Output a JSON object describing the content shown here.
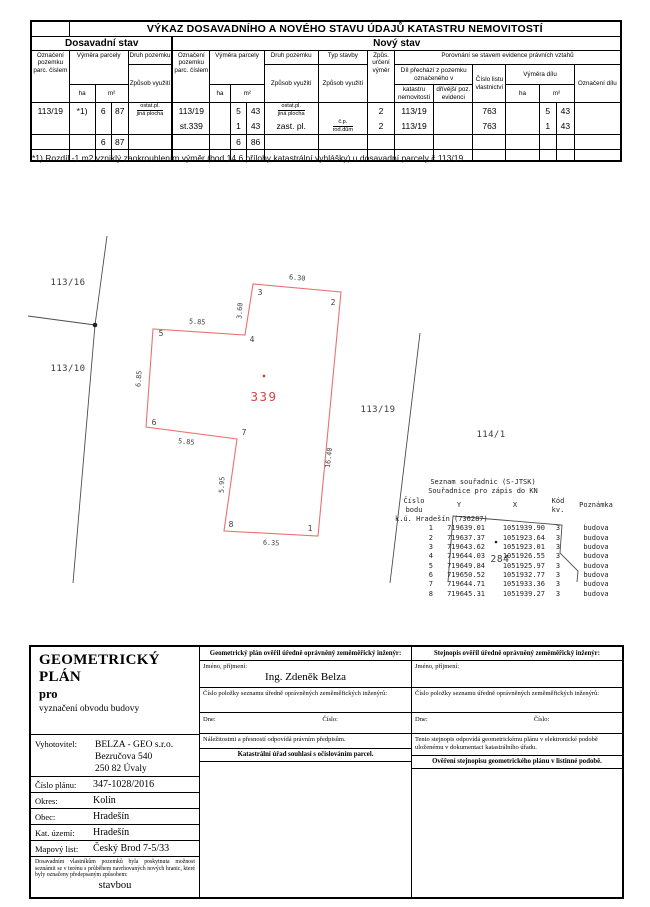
{
  "vykaz": {
    "title": "VÝKAZ DOSAVADNÍHO A NOVÉHO STAVU ÚDAJŮ KATASTRU NEMOVITOSTÍ",
    "section_old": "Dosavadní stav",
    "section_new": "Nový stav",
    "headers": {
      "ozn_pozemku": "Označení pozemku parc. číslem",
      "vymera_parcely": "Výměra parcely",
      "druh_pozemku": "Druh pozemku",
      "zpusob_vyuziti": "Způsob využití",
      "typ_stavby": "Typ stavby",
      "zpus_urceni": "Způs. určení výměr",
      "porovnani": "Porovnání se stavem evidence právních vztahů",
      "dil_prechazi": "Díl přechází z pozemku označeného v",
      "katastru": "katastru nemovitostí",
      "drivejsi": "dřívější poz. evidenci",
      "cislo_lv": "Číslo listu vlastnictví",
      "vymera_dilu": "Výměra dílu",
      "oznaceni_dilu": "Označení dílu",
      "ha": "ha",
      "m2": "m²"
    },
    "row1": {
      "old_parc": "113/19",
      "old_note": "*1)",
      "old_m2a": "6",
      "old_m2b": "87",
      "old_druh_top": "ostat.pl.",
      "old_druh_bot": "jiná plocha",
      "new_parc": "113/19",
      "new_m2a": "5",
      "new_m2b": "43",
      "new_druh_top": "ostat.pl.",
      "new_druh_bot": "jiná plocha",
      "zpus": "2",
      "kat": "113/19",
      "lv": "763",
      "dil_m2a": "5",
      "dil_m2b": "43"
    },
    "row2": {
      "new_parc": "st.339",
      "new_m2a": "1",
      "new_m2b": "43",
      "new_druh": "zast. pl.",
      "typ_top": "č.p.",
      "typ_bot": "rod.dům",
      "zpus": "2",
      "kat": "113/19",
      "lv": "763",
      "dil_m2a": "1",
      "dil_m2b": "43"
    },
    "totals": {
      "old_m2a": "6",
      "old_m2b": "87",
      "new_m2a": "6",
      "new_m2b": "86"
    }
  },
  "note": "*1) Rozdíl -1 m2 vzniklý zaokrouhlením výměr (bod 14.6 přílohy katastrální vyhlášky) u dosavadní parcely č.113/19",
  "drawing": {
    "boundary_lines": [
      {
        "name": "west-boundary",
        "points": [
          [
            107,
            8
          ],
          [
            95,
            97
          ],
          [
            73,
            355
          ]
        ]
      },
      {
        "name": "west-boundary-branch",
        "points": [
          [
            28,
            88
          ],
          [
            95,
            97
          ]
        ]
      },
      {
        "name": "east-boundary",
        "points": [
          [
            420,
            105
          ],
          [
            390,
            355
          ]
        ]
      }
    ],
    "building": {
      "number": "339",
      "points": [
        [
          318,
          308
        ],
        [
          341,
          64
        ],
        [
          253,
          56
        ],
        [
          245,
          107
        ],
        [
          153,
          101
        ],
        [
          146,
          199
        ],
        [
          237,
          211
        ],
        [
          224,
          303
        ]
      ]
    },
    "building_284": {
      "points": [
        [
          448,
          354
        ],
        [
          453,
          288
        ],
        [
          562,
          297
        ],
        [
          560,
          325
        ],
        [
          578,
          343
        ],
        [
          577,
          354
        ]
      ]
    },
    "dots": [
      {
        "name": "boundary-junction-dot",
        "cls": "black",
        "x": 95,
        "y": 97,
        "r": 2.3
      },
      {
        "name": "building-339-point",
        "cls": "red",
        "x": 264,
        "y": 148,
        "r": 1.4
      },
      {
        "name": "building-284-point",
        "cls": "black",
        "x": 496,
        "y": 314,
        "r": 1.3
      }
    ],
    "svg_labels": [
      {
        "t": "1",
        "x": 310,
        "y": 303,
        "cls": "vertex",
        "name": "vertex-label-1"
      },
      {
        "t": "2",
        "x": 333,
        "y": 77,
        "cls": "vertex",
        "name": "vertex-label-2"
      },
      {
        "t": "3",
        "x": 260,
        "y": 67,
        "cls": "vertex",
        "name": "vertex-label-3"
      },
      {
        "t": "4",
        "x": 252,
        "y": 114,
        "cls": "vertex",
        "name": "vertex-label-4"
      },
      {
        "t": "5",
        "x": 161,
        "y": 108,
        "cls": "vertex",
        "name": "vertex-label-5"
      },
      {
        "t": "6",
        "x": 154,
        "y": 197,
        "cls": "vertex",
        "name": "vertex-label-6"
      },
      {
        "t": "7",
        "x": 244,
        "y": 207,
        "cls": "vertex",
        "name": "vertex-label-7"
      },
      {
        "t": "8",
        "x": 231,
        "y": 299,
        "cls": "vertex",
        "name": "vertex-label-8"
      },
      {
        "t": "6.30",
        "x": 297,
        "y": 52,
        "r": 5,
        "cls": "dim",
        "name": "dim-label-6-30"
      },
      {
        "t": "3.60",
        "x": 242,
        "y": 83,
        "r": -86,
        "cls": "dim",
        "name": "dim-label-3-60"
      },
      {
        "t": "5.85",
        "x": 197,
        "y": 96,
        "r": 4,
        "cls": "dim",
        "name": "dim-label-5-85-a"
      },
      {
        "t": "6.85",
        "x": 141,
        "y": 151,
        "r": -86,
        "cls": "dim",
        "name": "dim-label-6-85"
      },
      {
        "t": "5.85",
        "x": 186,
        "y": 216,
        "r": 6,
        "cls": "dim",
        "name": "dim-label-5-85-b"
      },
      {
        "t": "5.95",
        "x": 224,
        "y": 257,
        "r": -87,
        "cls": "dim",
        "name": "dim-label-5-95"
      },
      {
        "t": "6.35",
        "x": 271,
        "y": 317,
        "r": 3,
        "cls": "dim",
        "name": "dim-label-6-35"
      },
      {
        "t": "16.40",
        "x": 331,
        "y": 230,
        "r": -84,
        "cls": "dim",
        "name": "dim-label-16-40"
      },
      {
        "t": "113/16",
        "x": 68,
        "y": 57,
        "cls": "parcel",
        "name": "parcel-label-113-16"
      },
      {
        "t": "113/10",
        "x": 68,
        "y": 143,
        "cls": "parcel",
        "name": "parcel-label-113-10"
      },
      {
        "t": "113/19",
        "x": 378,
        "y": 184,
        "cls": "parcel",
        "name": "parcel-label-113-19"
      },
      {
        "t": "114/1",
        "x": 491,
        "y": 209,
        "cls": "parcel",
        "name": "parcel-label-114-1"
      },
      {
        "t": "284",
        "x": 500,
        "y": 334,
        "cls": "p284",
        "name": "parcel-label-284"
      },
      {
        "t": "339",
        "x": 264,
        "y": 173,
        "cls": "bldnum",
        "name": "building-339-number"
      }
    ],
    "coord_list": {
      "title1": "Seznam souřadnic (S-JTSK)",
      "title2": "Souřadnice pro zápis do KN",
      "cols": [
        "Číslo bodu",
        "Y",
        "X",
        "Kód kv.",
        "Poznámka"
      ],
      "subheader": "k.ú. Hradešín (736287)",
      "rows": [
        [
          "1",
          "719639.01",
          "1051939.90",
          "3",
          "budova"
        ],
        [
          "2",
          "719637.37",
          "1051923.64",
          "3",
          "budova"
        ],
        [
          "3",
          "719643.62",
          "1051923.01",
          "3",
          "budova"
        ],
        [
          "4",
          "719644.03",
          "1051926.55",
          "3",
          "budova"
        ],
        [
          "5",
          "719649.84",
          "1051925.97",
          "3",
          "budova"
        ],
        [
          "6",
          "719650.52",
          "1051932.77",
          "3",
          "budova"
        ],
        [
          "7",
          "719644.71",
          "1051933.36",
          "3",
          "budova"
        ],
        [
          "8",
          "719645.31",
          "1051939.27",
          "3",
          "budova"
        ]
      ]
    }
  },
  "footer": {
    "left": {
      "title": "GEOMETRICKÝ PLÁN",
      "subtitle": "pro",
      "purpose": "vyznačení obvodu budovy",
      "vyhotovitel_label": "Vyhotovitel:",
      "vyhotovitel_lines": [
        "BELZA - GEO s.r.o.",
        "Bezručova 540",
        "250 82 Úvaly"
      ],
      "rows": [
        {
          "label": "Číslo plánu:",
          "value": "347-1028/2016"
        },
        {
          "label": "Okres:",
          "value": "Kolín"
        },
        {
          "label": "Obec:",
          "value": "Hradešín"
        },
        {
          "label": "Kat. území:",
          "value": "Hradešín"
        },
        {
          "label": "Mapový list:",
          "value": "Český Brod 7-5/33"
        }
      ],
      "smallprint": "Dosavadním vlastníkům pozemků byla poskytnuta možnost seznámit se v terénu s průběhem navrhovaných nových hranic, které byly označeny předepsaným způsobem:",
      "smallprint_value": "stavbou"
    },
    "middle": {
      "header": "Geometrický plán ověřil úředně oprávněný zeměměřický inženýr:",
      "name_label": "Jméno, příjmení:",
      "name_value": "Ing. Zdeněk Belza",
      "cislo_polozky": "Číslo položky seznamu úředně oprávněných zeměměřických inženýrů:",
      "dne_label": "Dne:",
      "cislo_label": "Číslo:",
      "footnote": "Náležitostmi a přesností odpovídá právním předpisům.",
      "section2": "Katastrální úřad souhlasí s očíslováním parcel."
    },
    "right": {
      "header": "Stejnopis ověřil úředně oprávněný zeměměřický inženýr:",
      "name_label": "Jméno, příjmení:",
      "name_value": "",
      "cislo_polozky": "Číslo položky seznamu úředně oprávněných zeměměřických inženýrů:",
      "dne_label": "Dne:",
      "cislo_label": "Číslo:",
      "footnote": "Tento stejnopis odpovídá geometrickému plánu v elektronické podobě uloženému v dokumentaci katastrálního úřadu.",
      "section2": "Ověření stejnopisu geometrického plánu v listinné podobě."
    }
  }
}
